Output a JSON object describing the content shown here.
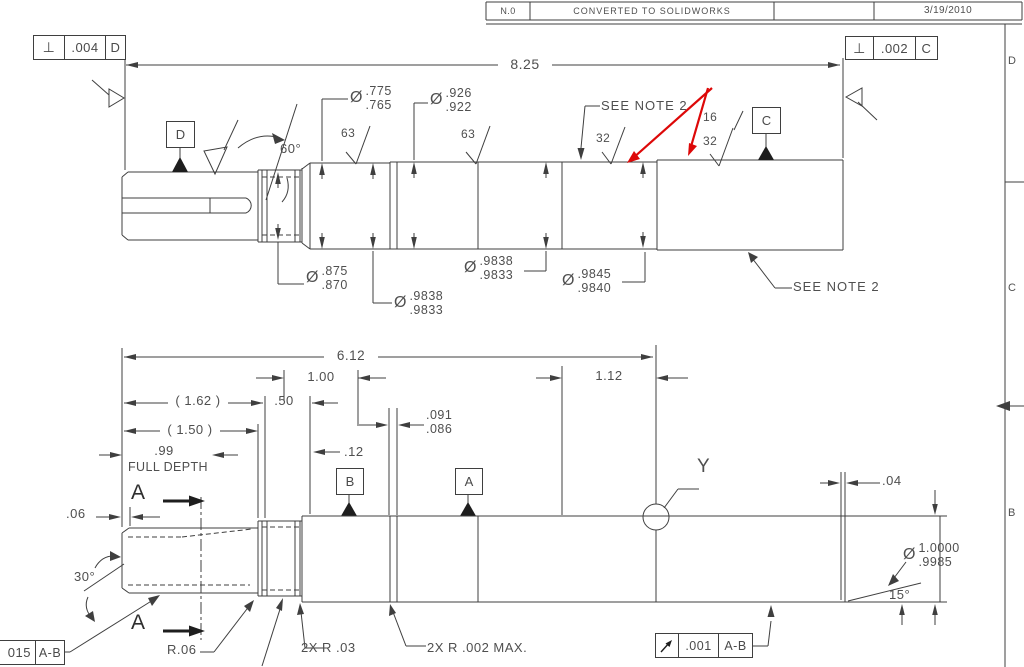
{
  "revision_table": {
    "rev": "N.0",
    "description": "CONVERTED TO SOLIDWORKS",
    "date": "3/19/2010"
  },
  "zones": {
    "d": "D",
    "c": "C",
    "b": "B"
  },
  "feature_control": {
    "perp_d": {
      "symbol": "⊥",
      "tol": ".004",
      "datum": "D"
    },
    "perp_c": {
      "symbol": "⊥",
      "tol": ".002",
      "datum": "C"
    },
    "runout": {
      "tol": ".001",
      "datum": "A-B"
    },
    "left_frame": {
      "tol": "015",
      "datum": "A-B"
    }
  },
  "datums": {
    "a": "A",
    "b": "B",
    "c": "C",
    "d": "D"
  },
  "upper_view": {
    "dia_sym": "Ø",
    "overall": "8.25",
    "angle_60": "60°",
    "see_note_top": "SEE NOTE 2",
    "see_note_right": "SEE NOTE 2",
    "finish_63a": "63",
    "finish_63b": "63",
    "finish_32a": "32",
    "finish_16": "16",
    "finish_32b": "32",
    "d775": {
      "hi": ".775",
      "lo": ".765"
    },
    "d926": {
      "hi": ".926",
      "lo": ".922"
    },
    "d875": {
      "hi": ".875",
      "lo": ".870"
    },
    "d9838a": {
      "hi": ".9838",
      "lo": ".9833"
    },
    "d9838b": {
      "hi": ".9838",
      "lo": ".9833"
    },
    "d9845": {
      "hi": ".9845",
      "lo": ".9840"
    }
  },
  "lower_view": {
    "dia_sym": "Ø",
    "overall": "6.12",
    "len_100": "1.00",
    "len_112": "1.12",
    "ref_162": "( 1.62 )",
    "ref_150": "( 1.50 )",
    "len_50": ".50",
    "depth_99": ".99",
    "full_depth": "FULL DEPTH",
    "len_12": ".12",
    "groove": {
      "hi": ".091",
      "lo": ".086"
    },
    "len_06": ".06",
    "len_04": ".04",
    "angle_30": "30°",
    "angle_15": "15°",
    "d10000": {
      "hi": "1.0000",
      "lo": ".9985"
    },
    "r06": "R.06",
    "r03": "2X R .03",
    "r002": "2X R .002 MAX.",
    "section": "A",
    "y_label": "Y"
  }
}
